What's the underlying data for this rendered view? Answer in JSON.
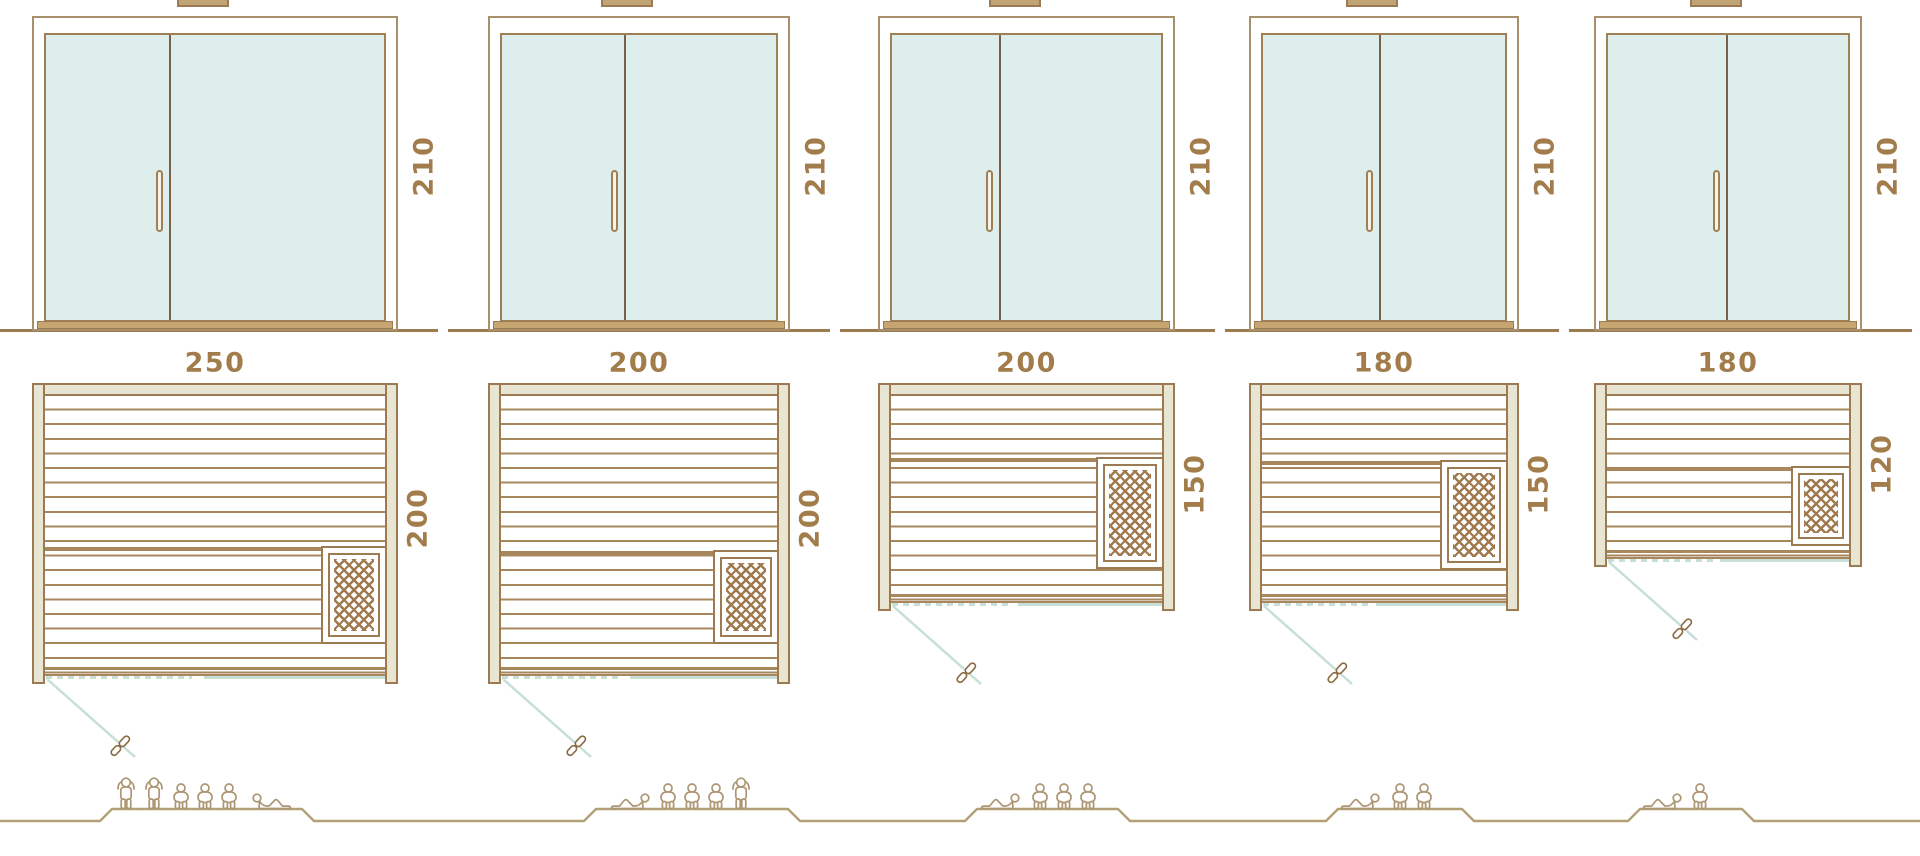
{
  "diagram": {
    "kind": "sauna-size-comparison",
    "units": "cm",
    "rows": [
      "door-elevations",
      "floor-plans",
      "capacity-figures"
    ]
  },
  "saunas": [
    {
      "id": "sauna-1",
      "width_label": "250",
      "depth_label": "200",
      "door_height_label": "210",
      "capacity": 6,
      "people": [
        "standing",
        "standing",
        "sitting",
        "sitting",
        "sitting",
        "lying"
      ]
    },
    {
      "id": "sauna-2",
      "width_label": "200",
      "depth_label": "200",
      "door_height_label": "210",
      "capacity": 5,
      "people": [
        "lying",
        "sitting",
        "sitting",
        "sitting",
        "standing"
      ]
    },
    {
      "id": "sauna-3",
      "width_label": "200",
      "depth_label": "150",
      "door_height_label": "210",
      "capacity": 4,
      "people": [
        "lying",
        "sitting",
        "sitting",
        "sitting"
      ]
    },
    {
      "id": "sauna-4",
      "width_label": "180",
      "depth_label": "150",
      "door_height_label": "210",
      "capacity": 3,
      "people": [
        "lying",
        "sitting",
        "sitting"
      ]
    },
    {
      "id": "sauna-5",
      "width_label": "180",
      "depth_label": "120",
      "door_height_label": "210",
      "capacity": 2,
      "people": [
        "lying",
        "sitting"
      ]
    }
  ],
  "colors": {
    "outline": "#9c7b52",
    "door_frame": "#a8906c",
    "glass_border": "#9f8055",
    "glass_fill": "#ddeeec",
    "door_divider": "#77614b",
    "handle_fill": "#f7f3e9",
    "sill": "#c7a571",
    "vent_fill": "#c0a473",
    "wall_fill": "#e8e5d2",
    "slat": "#a8875c",
    "lattice": "#a07a4e",
    "accent_blue": "#c6dfd9",
    "dimension_text": "#a27d4b",
    "people": "#ad9673",
    "baseline": "#b3a176"
  }
}
